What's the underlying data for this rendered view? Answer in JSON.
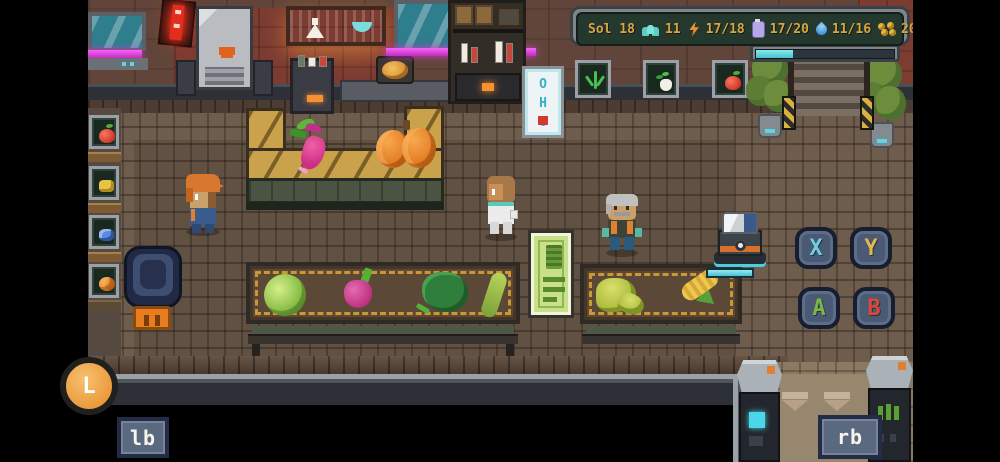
{
  "hud": {
    "sol": "Sol 18",
    "colonists": "11",
    "energy": "17/18",
    "oxygen": "17/20",
    "water": "11/16",
    "money": "200g",
    "progress_pct": 27
  },
  "vending": {
    "letters": "OHO"
  },
  "controls": {
    "x": "X",
    "y": "Y",
    "a": "A",
    "b": "B",
    "l": "L",
    "lb": "lb",
    "rb": "rb"
  },
  "scene": {
    "characters": [
      "player",
      "scientist-npc",
      "elder-npc"
    ],
    "wall_signs": [
      "sprout",
      "turnip",
      "apple"
    ],
    "left_rack_items": [
      "apple",
      "yellow-fruit",
      "blue-fruit",
      "pumpkin"
    ],
    "counter_items": [
      "radish",
      "pumpkins"
    ],
    "stall_left_items": [
      "cabbage",
      "radish",
      "kale",
      "cucumber"
    ],
    "stall_right_items": [
      "melon",
      "corn"
    ]
  },
  "colors": {
    "hud_text": "#d9a441",
    "hud_panel": "#24382e",
    "progress_fill": "#46c4cc",
    "neon_magenta": "#d23ad2",
    "neon_red": "#e22d1c",
    "sign_orange": "#f09038",
    "btn_face": "#4a5a74",
    "btn_x": "#6ecfe0",
    "btn_y": "#e0b84a",
    "btn_a": "#7ab648",
    "btn_b": "#d84838",
    "l_button": "#eb9b3e"
  }
}
